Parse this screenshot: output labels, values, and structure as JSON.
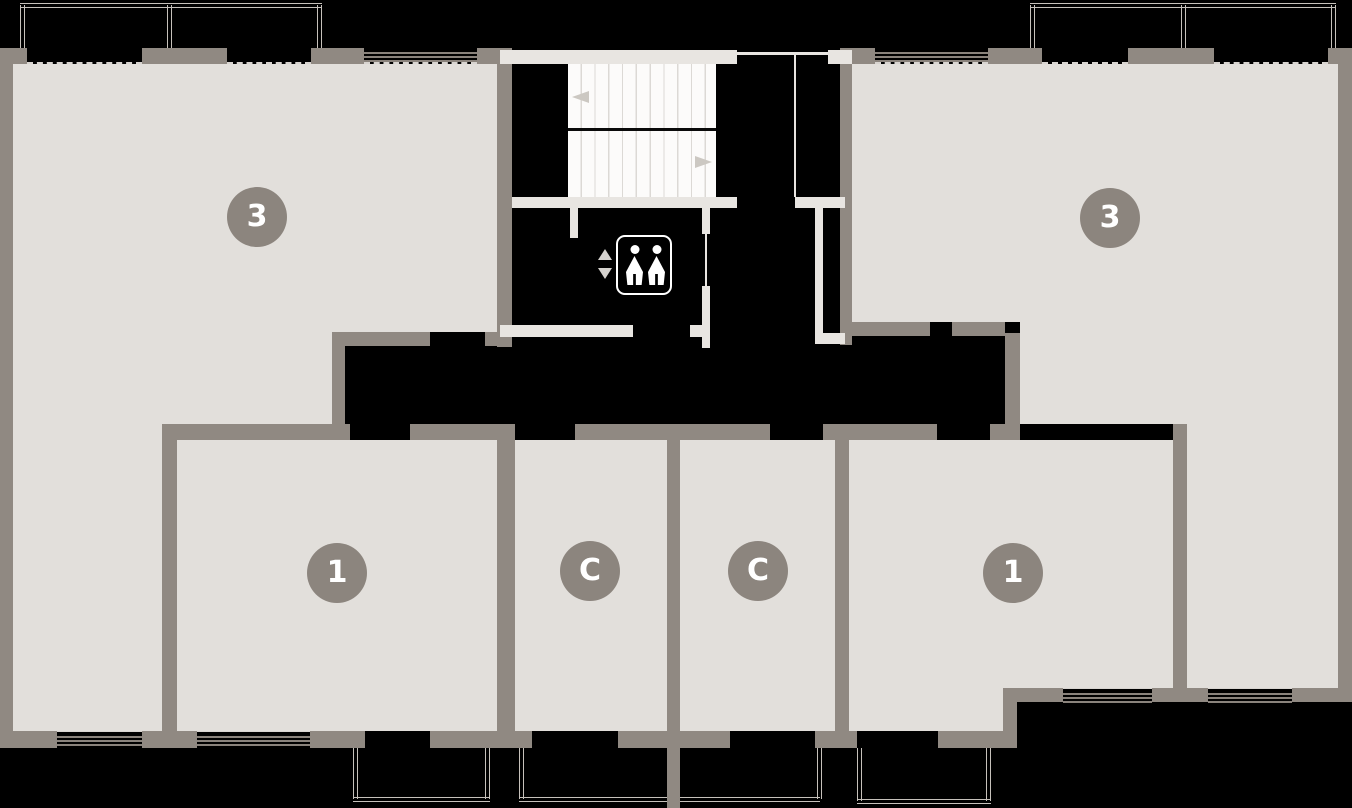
{
  "plan": {
    "title": "apartment-floor-plan",
    "background": "#000000",
    "room_fill": "#e2dfdb",
    "wall_color": "#908982",
    "light_wall_color": "#e8e5e1",
    "badge_color": "#8c857e",
    "badge_text_color": "#ffffff",
    "units": [
      {
        "id": "apartment-3-left",
        "label": "3"
      },
      {
        "id": "apartment-3-right",
        "label": "3"
      },
      {
        "id": "apartment-1-left",
        "label": "1"
      },
      {
        "id": "studio-left",
        "label": "С"
      },
      {
        "id": "studio-right",
        "label": "С"
      },
      {
        "id": "apartment-1-right",
        "label": "1"
      }
    ],
    "stairs": {
      "flights": 2,
      "upper_flight_arrow": "left",
      "lower_flight_arrow": "right"
    },
    "elevator": {
      "persons": 2,
      "call_arrows": [
        "up",
        "down"
      ]
    }
  }
}
